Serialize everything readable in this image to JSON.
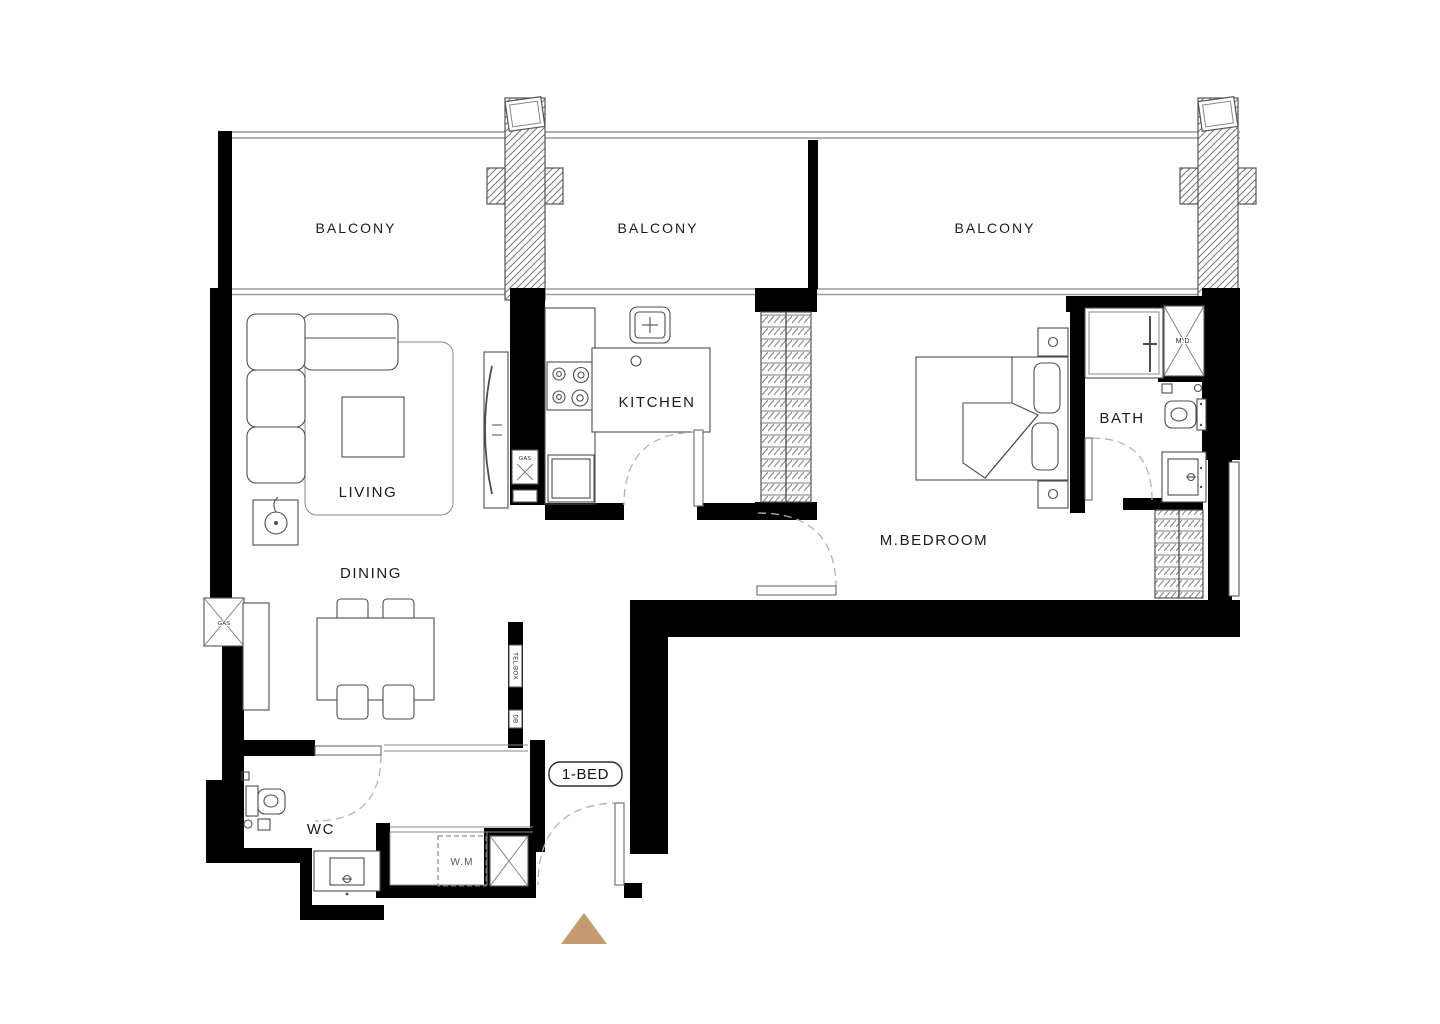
{
  "unit": {
    "badge": "1-BED"
  },
  "rooms": {
    "balcony_1": "BALCONY",
    "balcony_2": "BALCONY",
    "balcony_3": "BALCONY",
    "living": "LIVING",
    "dining": "DINING",
    "kitchen": "KITCHEN",
    "master_bedroom": "M.BEDROOM",
    "bath": "BATH",
    "wc": "WC"
  },
  "annotations": {
    "washing_machine": "W.M",
    "gas_meter_wall": "GAS",
    "gas_meter_kitchen": "GAS",
    "mechanical_duct": "M.D.",
    "tel_box": "TEL.BOX",
    "distribution_board": "DB"
  },
  "colors": {
    "wall": "#000000",
    "furniture_line": "#4d4d4d",
    "window_line": "#9a9a9a",
    "door_arc": "#b3b3b3",
    "entry_marker": "#c49a70"
  }
}
